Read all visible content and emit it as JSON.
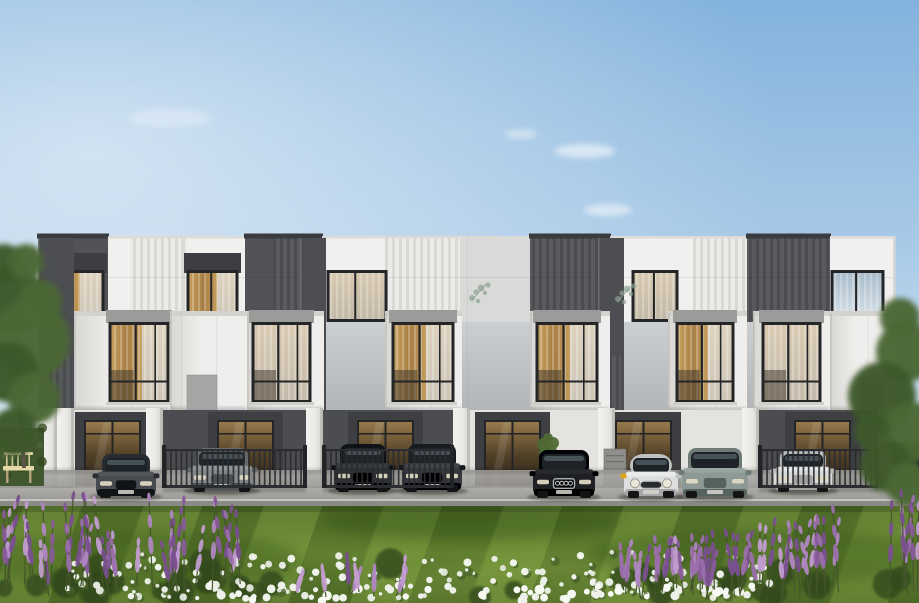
{
  "scene": {
    "description": "Photorealistic architectural rendering of a modern three-storey townhouse row with white and dark grey panelled facades, eight parked cars, black metal fences, a striped green lawn, white flower bed and purple salvia bushes under a clear blue sky",
    "width": 919,
    "height": 603
  },
  "colors": {
    "sky_top": "#83b3dd",
    "sky_mid": "#a6c8e6",
    "sky_low": "#cadfef",
    "sky_horizon": "#e9f0f5",
    "cloud": "#ffffff",
    "panel_white": "#f1f0ee",
    "panel_gray": "#d9dad8",
    "panel_dark": "#515357",
    "rib_white_a": "#ebebe9",
    "rib_white_b": "#dad9d5",
    "rib_dark_a": "#595b5f",
    "rib_dark_b": "#4a4c50",
    "slab": "#4c4e52",
    "box_a": "#efeeec",
    "box_b": "#d8d7d3",
    "box_cap": "#d3d2ce",
    "recess_a": "#cccfd1",
    "recess_b": "#b2b5b7",
    "window_frame": "#232527",
    "window_cap": "#9b9c9a",
    "curtain_a": "#c79e5c",
    "curtain_b": "#a87d41",
    "curtain_sheer": "#e6e2d8",
    "glass_warm_a": "#b68d52",
    "glass_warm_b": "#6e5534",
    "glass_cool_a": "#a9bcca",
    "glass_cool_b": "#d8e2e8",
    "shade_box": "#3c3e42",
    "ground_wall": "#e4e3df",
    "carport_back": "#4b4d50",
    "door_surround": "#3d3f42",
    "door_glass_a": "#97794b",
    "door_glass_b": "#4e3e25",
    "step": "#cbc9c4",
    "pillar_a": "#e9e8e4",
    "pillar_b": "#cfcec9",
    "fence": "#2b2d30",
    "fence_post": "#222427",
    "pave_a": "#b0aeaa",
    "pave_b": "#9a9894",
    "road": "#8b8986",
    "curb": "#c6c4c0",
    "base_line": "#75736e",
    "lawn_a": "#6a8a35",
    "lawn_b": "#4e6b27",
    "lawn_light": "#7fa044",
    "lawn_dark": "#3f5c20",
    "lawn_shadow": "#24400f",
    "foliage_a": "#4c6836",
    "foliage_b": "#3e592b",
    "trunk": "#5c5349",
    "hedge": "#41572f",
    "flower_leaf": "#49642b",
    "bench": "#e6d9a8",
    "bench_leg": "#b3a278",
    "utility": "#8f8e8a",
    "decal": "#8ba194"
  },
  "sky": {
    "clouds": [
      {
        "x": 585,
        "y": 151,
        "rx": 30,
        "ry": 7,
        "o": 0.55
      },
      {
        "x": 608,
        "y": 210,
        "rx": 24,
        "ry": 6,
        "o": 0.5
      },
      {
        "x": 521,
        "y": 134,
        "rx": 16,
        "ry": 5,
        "o": 0.4
      },
      {
        "x": 170,
        "y": 118,
        "rx": 42,
        "ry": 9,
        "o": 0.28
      }
    ]
  },
  "building": {
    "x": 38,
    "right": 895,
    "top": 236,
    "ground": 492,
    "units": 6,
    "floors": 3,
    "unit_joints": [
      181,
      324,
      467,
      610,
      753
    ],
    "top_panels": [
      {
        "x": 38,
        "w": 70,
        "style": "dark"
      },
      {
        "x": 108,
        "w": 22,
        "style": "white"
      },
      {
        "x": 130,
        "w": 57,
        "style": "rib_white"
      },
      {
        "x": 187,
        "w": 58,
        "style": "white"
      },
      {
        "x": 245,
        "w": 28,
        "style": "dark"
      },
      {
        "x": 273,
        "w": 49,
        "style": "rib_dark"
      },
      {
        "x": 322,
        "w": 63,
        "style": "white"
      },
      {
        "x": 385,
        "w": 75,
        "style": "rib_white"
      },
      {
        "x": 460,
        "w": 70,
        "style": "gray"
      },
      {
        "x": 530,
        "w": 80,
        "style": "rib_dark"
      },
      {
        "x": 610,
        "w": 83,
        "style": "white"
      },
      {
        "x": 693,
        "w": 54,
        "style": "rib_white"
      },
      {
        "x": 747,
        "w": 83,
        "style": "rib_dark"
      },
      {
        "x": 830,
        "w": 65,
        "style": "white"
      }
    ],
    "top_windows": [
      {
        "x": 46,
        "w": 57,
        "curtain": "gold"
      },
      {
        "x": 188,
        "w": 49,
        "curtain": "gold"
      },
      {
        "x": 328,
        "w": 58,
        "curtain": "sheer"
      },
      {
        "x": 633,
        "w": 44,
        "curtain": "sheer"
      },
      {
        "x": 832,
        "w": 51,
        "curtain": "glass"
      }
    ],
    "slabs": [
      {
        "x": 38,
        "w": 36
      },
      {
        "x": 300,
        "w": 26
      },
      {
        "x": 598,
        "w": 26
      }
    ],
    "boxes": [
      {
        "x": 74,
        "w": 96,
        "win": {
          "x": 110,
          "w": 58,
          "curtain": "gold"
        }
      },
      {
        "x": 170,
        "w": 77,
        "win": null
      },
      {
        "x": 247,
        "w": 77,
        "win": {
          "x": 253,
          "w": 57,
          "curtain": "sheer"
        }
      },
      {
        "x": 385,
        "w": 77,
        "win": {
          "x": 393,
          "w": 60,
          "curtain": "gold"
        }
      },
      {
        "x": 530,
        "w": 80,
        "win": {
          "x": 537,
          "w": 60,
          "curtain": "gold"
        }
      },
      {
        "x": 668,
        "w": 79,
        "win": {
          "x": 677,
          "w": 56,
          "curtain": "gold"
        }
      },
      {
        "x": 753,
        "w": 77,
        "win": {
          "x": 763,
          "w": 57,
          "curtain": "sheer"
        }
      },
      {
        "x": 830,
        "w": 63,
        "win": null
      }
    ],
    "gray_insets": [
      {
        "x": 187,
        "y": 375,
        "w": 30,
        "h": 35
      },
      {
        "x": 862,
        "y": 378,
        "w": 21,
        "h": 29
      }
    ],
    "decals": [
      {
        "x": 472,
        "y": 284
      },
      {
        "x": 618,
        "y": 285
      }
    ],
    "carports": [
      {
        "x": 163,
        "w": 143
      },
      {
        "x": 323,
        "w": 130
      },
      {
        "x": 759,
        "w": 119
      }
    ],
    "doors": [
      {
        "x": 85
      },
      {
        "x": 218
      },
      {
        "x": 358
      },
      {
        "x": 485
      },
      {
        "x": 616
      },
      {
        "x": 795
      }
    ],
    "door_w": 55,
    "pillars": [
      40,
      57,
      146,
      306,
      453,
      598,
      742,
      878
    ],
    "pillar_w": 17
  },
  "fences": [
    {
      "x": 163,
      "w": 143
    },
    {
      "x": 323,
      "w": 130
    },
    {
      "x": 759,
      "w": 119
    },
    {
      "x": 895,
      "w": 24
    }
  ],
  "cars": [
    {
      "label": "dark grey sedan",
      "type": "sedan",
      "x": 96,
      "w": 60,
      "h": 44,
      "color": "#474a4e",
      "front": true
    },
    {
      "label": "grey sedan",
      "type": "sedan",
      "x": 190,
      "w": 64,
      "h": 44,
      "color": "#83878a",
      "front": false
    },
    {
      "label": "black suv",
      "type": "suv",
      "x": 334,
      "w": 58,
      "h": 48,
      "color": "#2d3034",
      "front": false
    },
    {
      "label": "dark suv",
      "type": "suv",
      "x": 402,
      "w": 60,
      "h": 48,
      "color": "#35383c",
      "front": false
    },
    {
      "label": "black audi suv",
      "type": "audi",
      "x": 533,
      "w": 62,
      "h": 48,
      "color": "#1e2023",
      "front": true
    },
    {
      "label": "white mini hatch",
      "type": "mini",
      "x": 624,
      "w": 54,
      "h": 44,
      "color": "#dde0df",
      "front": true,
      "mirror": "#d9a514"
    },
    {
      "label": "sage green suv",
      "type": "suv",
      "x": 682,
      "w": 66,
      "h": 50,
      "color": "#8c9995",
      "front": true
    },
    {
      "label": "white sedan",
      "type": "sedan",
      "x": 774,
      "w": 58,
      "h": 42,
      "color": "#d7dad9",
      "front": false
    }
  ],
  "landscape": {
    "hedge_left": {
      "x": 0,
      "y": 428,
      "w": 44,
      "h": 58
    },
    "hedge_right": {
      "x": 893,
      "y": 442,
      "w": 26,
      "h": 46
    },
    "bench": {
      "x": 3,
      "y": 452,
      "w": 31,
      "h": 32
    },
    "utility_box": {
      "x": 604,
      "y": 449,
      "w": 22,
      "h": 41
    },
    "plant_pot": {
      "x": 542,
      "y": 444
    },
    "trees_left": [
      [
        12,
        300,
        34
      ],
      [
        30,
        340,
        40
      ],
      [
        8,
        372,
        30
      ],
      [
        34,
        398,
        26
      ],
      [
        14,
        432,
        24
      ],
      [
        40,
        302,
        22
      ],
      [
        4,
        264,
        20
      ],
      [
        26,
        262,
        18
      ]
    ],
    "trees_right": [
      [
        906,
        352,
        30
      ],
      [
        882,
        396,
        34
      ],
      [
        912,
        432,
        30
      ],
      [
        886,
        466,
        26
      ],
      [
        908,
        484,
        22
      ],
      [
        872,
        432,
        18
      ],
      [
        900,
        318,
        20
      ]
    ],
    "lawn": {
      "y": 506,
      "stripes": 9
    },
    "flowers": {
      "white_count": 170,
      "white_edge_count": 60,
      "purple_left_count": 44,
      "purple_right_count": 52,
      "purple_mid_count": 8,
      "palette": [
        "#9d6fb0",
        "#b288c6",
        "#8a5a9e",
        "#c49ed4",
        "#7b4f91"
      ]
    }
  }
}
